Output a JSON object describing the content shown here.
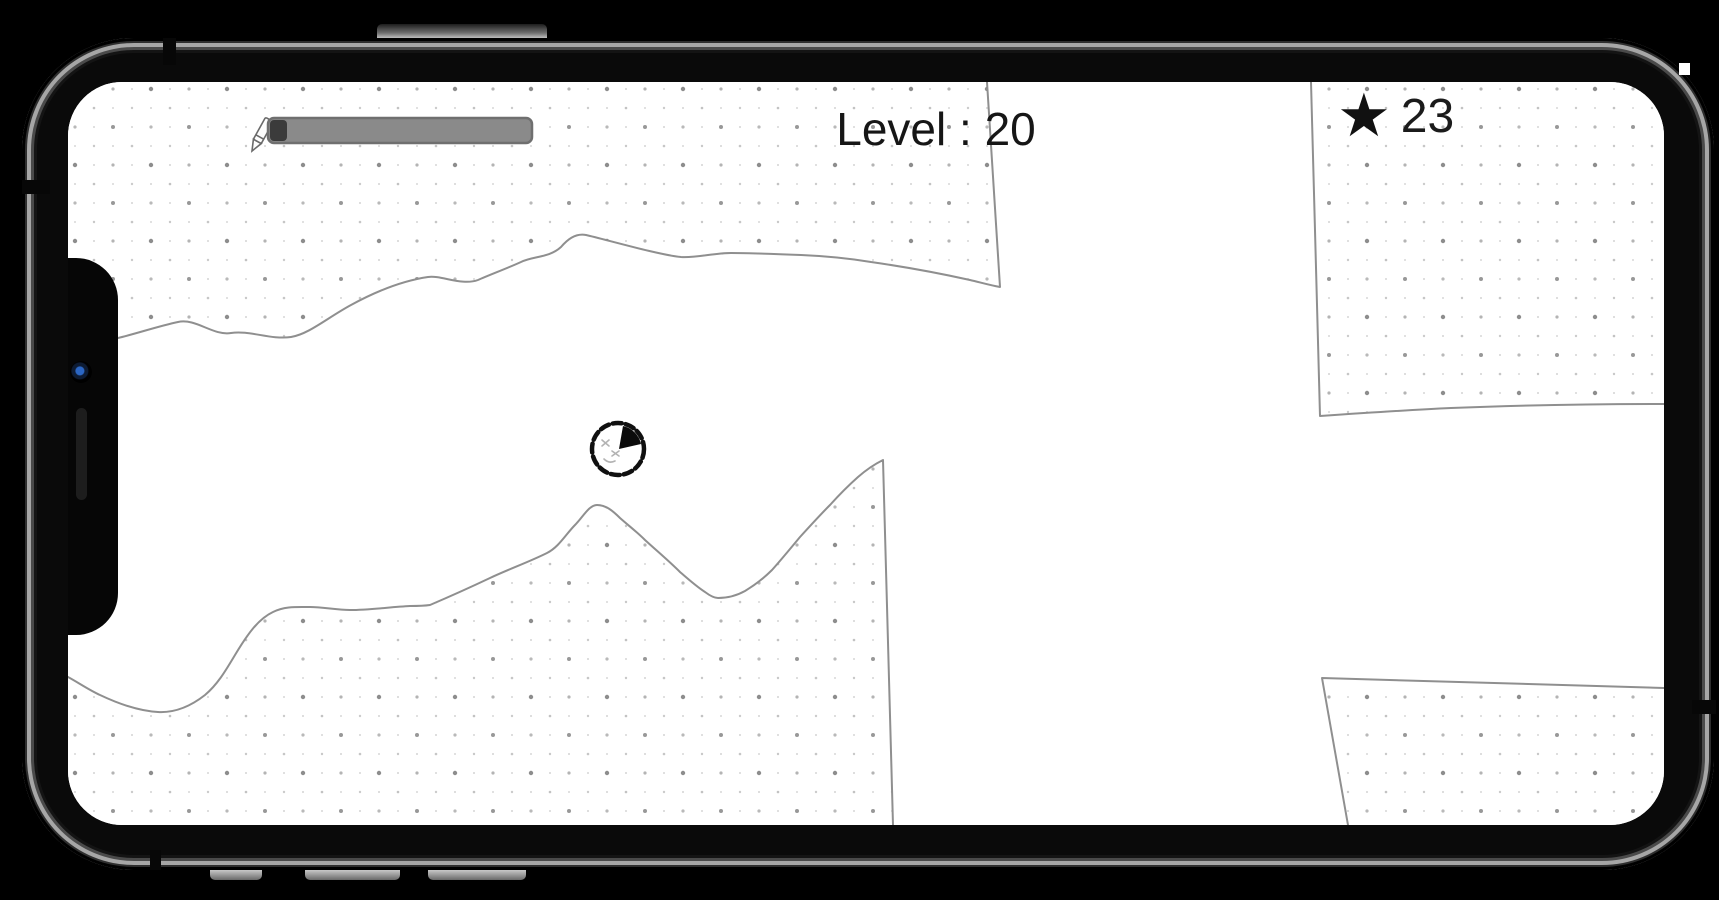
{
  "device": {
    "type": "smartphone-landscape-mockup",
    "frame_color": "#0a0a0a",
    "frame_highlight": "#a6a6a6",
    "screen_bg": "#ffffff",
    "camera_color": "#2b66c4"
  },
  "hud": {
    "level_label": "Level : 20",
    "star_icon": "★",
    "star_count": "23",
    "ink_meter": {
      "icon": "pencil-icon",
      "track_color": "#8a8a8a",
      "used_color": "#3b3b3b",
      "border_color": "#6f6f6f",
      "used_fraction": 0.06
    }
  },
  "game": {
    "character": "sketch-ball-character",
    "terrain_style": "dotted-paper",
    "terrain_regions": [
      "top-left",
      "bottom-left",
      "top-right",
      "bottom-right"
    ],
    "line_color": "#8f8f8f",
    "dot_color": "#8d8d8d",
    "text_color": "#161616"
  }
}
